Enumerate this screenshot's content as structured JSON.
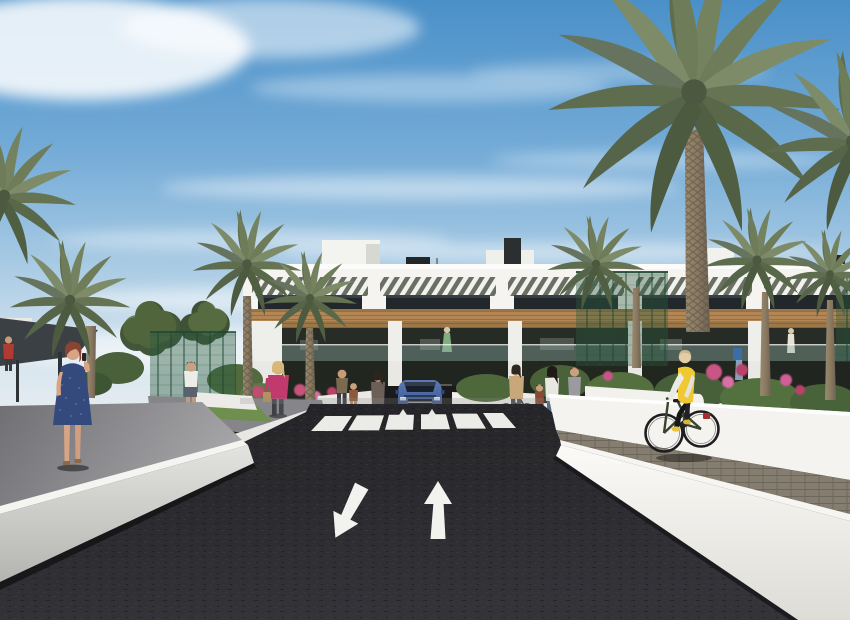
{
  "scene": {
    "title": "Architectural rendering — street view of a modern residential complex",
    "type": "3D exterior visualization, no UI text visible",
    "sky": {
      "description": "blue sky with wispy cirrus clouds",
      "color_top": "#4a90c8",
      "color_horizon": "#e9eef0"
    },
    "building": {
      "storeys": 3,
      "style": "white contemporary block with timber fascia, louvre pergolas and glass balconies",
      "wall_color": "#f5f4f1",
      "timber_color": "#b28655",
      "glazing_color": "#23282a",
      "balcony_units": 5,
      "roof_features": [
        "stair bulkhead",
        "chimney",
        "parasol",
        "vents"
      ]
    },
    "road": {
      "surface": "asphalt",
      "color": "#28282c",
      "markings": [
        {
          "name": "zebra-crossing",
          "stripes": 6,
          "color": "#ebebe7"
        },
        {
          "name": "lane-arrow-towards-viewer",
          "direction": "down-left",
          "color": "#ffffff"
        },
        {
          "name": "lane-arrow-away",
          "direction": "up",
          "color": "#ffffff"
        },
        {
          "name": "ramp-mini-arrows",
          "count": 2,
          "color": "#ffffff"
        }
      ]
    },
    "vehicle": {
      "type": "SUV exiting basement ramp",
      "color": "#4f6da8"
    },
    "people": [
      {
        "name": "woman-blue-dress",
        "detail": "auburn hair, navy dress, phone to ear, left sidewalk"
      },
      {
        "name": "man-white-shirt",
        "detail": "white tee, dark shorts, walking on garden path"
      },
      {
        "name": "woman-pink-top",
        "detail": "blonde, magenta top, dark trousers, tan bag"
      },
      {
        "name": "woman-by-crossing",
        "detail": "taupe top, jeans, standing at zebra end"
      },
      {
        "name": "adult-and-child-by-ramp",
        "detail": "standing beside ramp wall"
      },
      {
        "name": "group-right-walkway",
        "detail": "woman with bicycle, child, woman in white top, walking woman"
      },
      {
        "name": "cyclist",
        "detail": "yellow vest, white sleeves, black leggings, dark green bicycle on raised paver path"
      },
      {
        "name": "balcony-residents",
        "detail": "small figures on first-floor balconies"
      }
    ],
    "vegetation": {
      "palm_trees": 9,
      "deciduous_trees": 2,
      "frond_color": "#6e7c5a",
      "flower_colors": [
        "#d864a0",
        "#c24b72"
      ],
      "hedge_color": "#51693d"
    },
    "walls_and_paths": {
      "retaining_wall_color": "#f4f3ef",
      "left_sidewalk_color": "#8a8a8e",
      "right_paver_color": "#857d6f",
      "green_mesh_fence_color": "#2e5c40",
      "shade_pergola_color": "#3b4045"
    }
  }
}
